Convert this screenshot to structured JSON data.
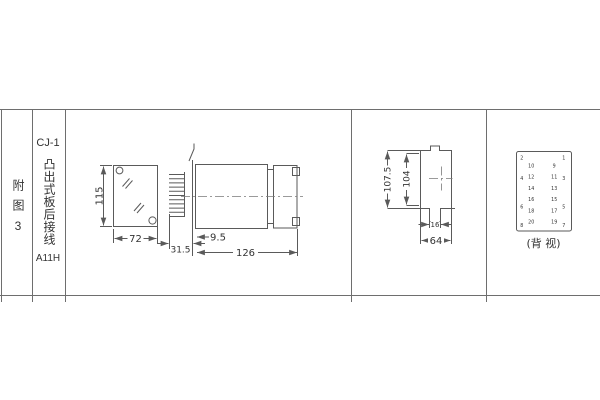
{
  "title_block": {
    "figure_label": "附图3",
    "model": "CJ-1",
    "mounting_type": "凸出式板后接线",
    "code": "A11H"
  },
  "front_view": {
    "height_dim": "115",
    "width_dim": "72"
  },
  "side_view": {
    "front_offset_dim": "9.5",
    "pin_length_dim": "31.5",
    "length_dim": "126"
  },
  "profile_view": {
    "overall_height_dim": "107.5",
    "body_height_dim": "104",
    "stud_width_dim": "16",
    "width_dim": "64"
  },
  "rear_view": {
    "caption": "(背 视)",
    "terminals": [
      "1",
      "2",
      "3",
      "4",
      "5",
      "6",
      "7",
      "8",
      "9",
      "10",
      "11",
      "12",
      "13",
      "14",
      "15",
      "16",
      "17",
      "18",
      "19",
      "20"
    ]
  }
}
